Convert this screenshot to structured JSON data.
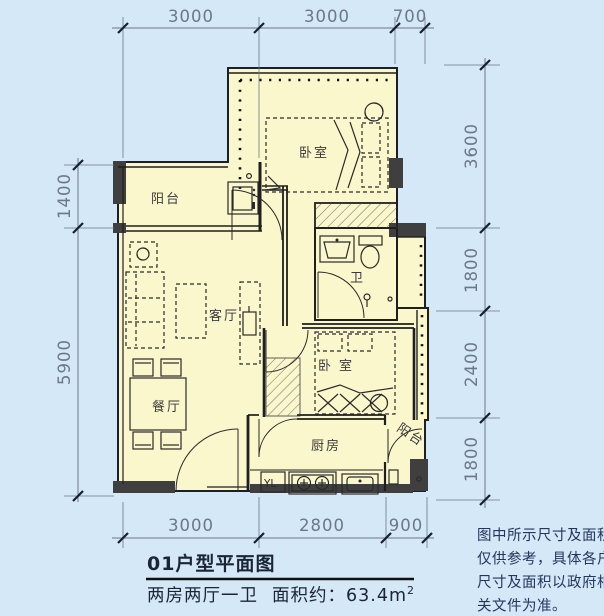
{
  "plan": {
    "rooms": {
      "balcony_top": "阳台",
      "bedroom_top": "卧室",
      "living": "客厅",
      "bath": "卫",
      "dining": "餐厅",
      "bedroom_right": "卧室",
      "kitchen": "厨房",
      "balcony_bottom": "阳台"
    },
    "fixtures": {
      "washer_label": "YL"
    },
    "dimensions": {
      "top": [
        "3000",
        "3000",
        "700"
      ],
      "right": [
        "3600",
        "1800",
        "2400",
        "1800"
      ],
      "left": [
        "1400",
        "5900"
      ],
      "bottom": [
        "3000",
        "2800",
        "900"
      ]
    },
    "footer": {
      "title": "01户型平面图",
      "layout": "两房两厅一卫",
      "area_prefix": "面积约：63.4m",
      "area_sup": "2"
    },
    "note_lines": [
      "图中所示尺寸及面积",
      "仅供参考，具体各户",
      "尺寸及面积以政府相",
      "关文件为准。"
    ],
    "colors": {
      "background": "#d4e8f7",
      "room_fill": "#faf7cd",
      "wall": "#1f1f1f",
      "poche": "#3f3f3f",
      "dimension": "#6b7887",
      "note_text": "#24365e",
      "title_text": "#1b2534"
    }
  }
}
